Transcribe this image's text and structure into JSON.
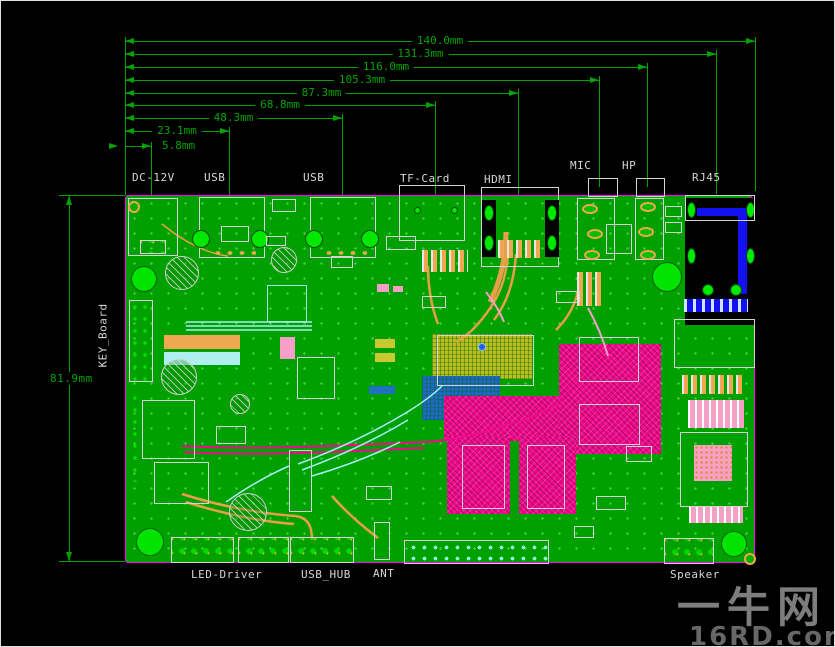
{
  "drawing": {
    "type": "pcb-layout-dimension-drawing",
    "board_color": "#00a000",
    "edge_color": "#ff00ff",
    "dimension_color": "#00a400",
    "label_color": "#d6d6d6"
  },
  "dims": {
    "top": [
      "140.0mm",
      "131.3mm",
      "116.0mm",
      "105.3mm",
      "87.3mm",
      "68.8mm",
      "48.3mm",
      "23.1mm",
      "5.8mm"
    ],
    "left": "81.9mm"
  },
  "measurements_mm": {
    "top_edge_offsets": [
      140.0,
      131.3,
      116.0,
      105.3,
      87.3,
      68.8,
      48.3,
      23.1,
      5.8
    ],
    "board_height": 81.9
  },
  "ports": {
    "top": [
      "DC-12V",
      "USB",
      "USB",
      "TF-Card",
      "HDMI",
      "MIC",
      "HP",
      "RJ45"
    ],
    "bottom": [
      "LED-Driver",
      "USB_HUB",
      "ANT",
      "Speaker"
    ],
    "left": [
      "KEY_Board"
    ]
  },
  "watermark": {
    "cn": "一牛网",
    "en": "16RD.com"
  }
}
